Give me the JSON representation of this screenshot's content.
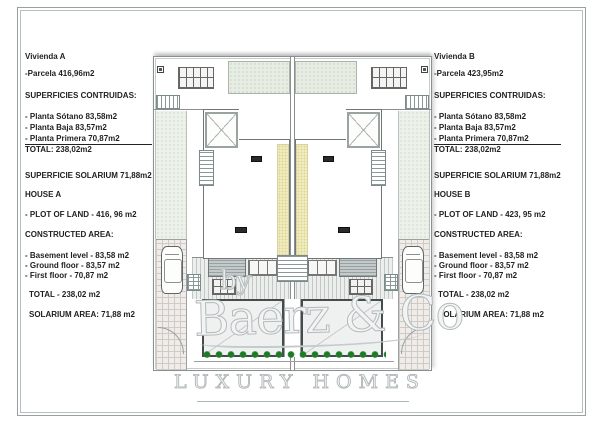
{
  "panel_a": {
    "lines": [
      "Vivienda A",
      "-Parcela 416,96m2",
      "SUPERFICIES CONTRUIDAS:",
      "- Planta Sótano 83,58m2",
      "- Planta Baja 83,57m2",
      "- Planta Primera 70,87m2",
      "TOTAL: 238,02m2",
      "SUPERFICIE SOLARIUM 71,88m2",
      "HOUSE A",
      "- PLOT OF LAND - 416, 96 m2",
      "CONSTRUCTED AREA:",
      "- Basement level - 83,58 m2",
      "- Ground floor - 83,57 m2",
      "- First floor - 70,87 m2",
      "TOTAL - 238,02 m2",
      "SOLARIUM AREA: 71,88 m2"
    ]
  },
  "panel_b": {
    "lines": [
      "Vivienda B",
      "-Parcela 423,95m2",
      "SUPERFICIES CONTRUIDAS:",
      "- Planta Sótano 83,58m2",
      "- Planta Baja 83,57m2",
      "- Planta Primera 70,87m2",
      "TOTAL: 238,02m2",
      "SUPERFICIE SOLARIUM 71,88m2",
      "HOUSE B",
      "- PLOT OF LAND - 423, 95 m2",
      "CONSTRUCTED AREA:",
      "- Basement level - 83,58 m2",
      "- Ground floor - 83,57 m2",
      "- First floor - 70,87 m2",
      "TOTAL - 238,02 m2",
      "SOLARIUM AREA: 71,88 m2"
    ]
  },
  "watermark": {
    "by": "by",
    "brand": "Baerz & Co",
    "tagline": "LUXURY HOMES"
  },
  "colors": {
    "plan_green": "#e7ede3",
    "hedge_yellow": "#f0ecc0",
    "plant_green": "#1f7a28",
    "watermark_gray": "#b3babb"
  }
}
